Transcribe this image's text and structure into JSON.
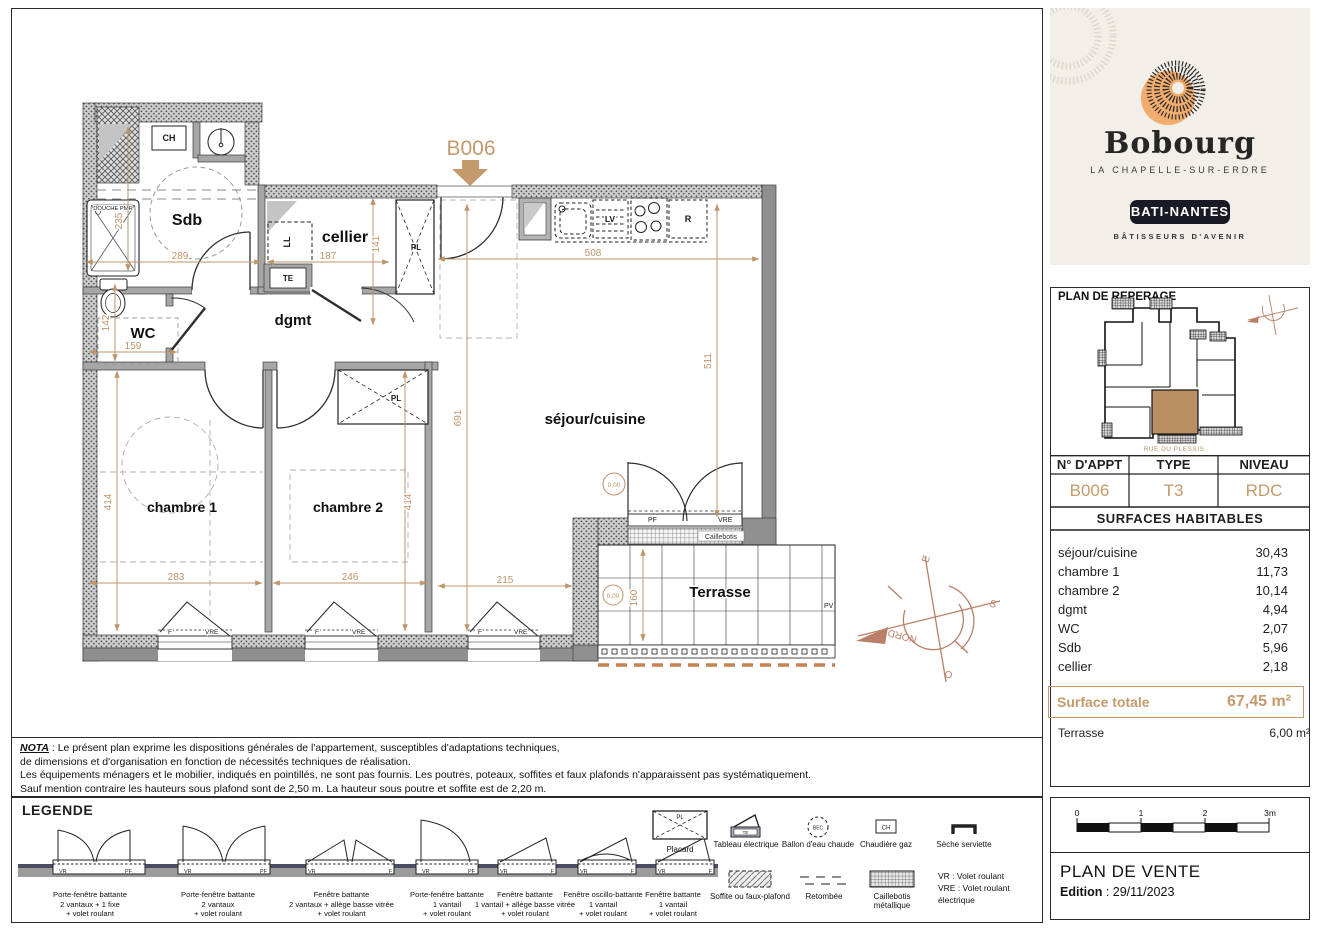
{
  "colors": {
    "accent": "#C49A6C",
    "terracotta": "#B97F68",
    "cream": "#F1EFE7",
    "wall": "#9a9a9a"
  },
  "brand": {
    "name": "Bobourg",
    "location": "LA CHAPELLE-SUR-ERDRE",
    "builder": "BATI-NANTES",
    "tagline": "BÂTISSEURS D'AVENIR"
  },
  "reperage": {
    "title": "PLAN DE REPERAGE",
    "street": "RUE DU PLESSIS"
  },
  "apt": {
    "col1": "N° D'APPT",
    "col2": "TYPE",
    "col3": "NIVEAU",
    "num": "B006",
    "type": "T3",
    "level": "RDC"
  },
  "surfaces": {
    "title": "SURFACES HABITABLES",
    "rows": [
      {
        "label": "séjour/cuisine",
        "value": "30,43"
      },
      {
        "label": "chambre 1",
        "value": "11,73"
      },
      {
        "label": "chambre 2",
        "value": "10,14"
      },
      {
        "label": "dgmt",
        "value": "4,94"
      },
      {
        "label": "WC",
        "value": "2,07"
      },
      {
        "label": "Sdb",
        "value": "5,96"
      },
      {
        "label": "cellier",
        "value": "2,18"
      }
    ],
    "total_label": "Surface totale",
    "total_value": "67,45 m²",
    "terrace_label": "Terrasse",
    "terrace_value": "6,00 m²"
  },
  "scalebar": {
    "t0": "0",
    "t1": "1",
    "t2": "2",
    "t3": "3m"
  },
  "vente": {
    "title": "PLAN DE VENTE",
    "edition_label": "Edition",
    "edition_value": " : 29/11/2023"
  },
  "nota": {
    "label": "NOTA",
    "l1": " : Le présent plan exprime les dispositions générales de l'appartement, susceptibles d'adaptations techniques,",
    "l2": "de dimensions et d'organisation en fonction de nécessités techniques de réalisation.",
    "l3": "Les équipements ménagers  et le mobilier, indiqués en pointillés, ne sont pas fournis. Les poutres, poteaux, soffites et faux plafonds n'apparaissent pas systématiquement.",
    "l4": "Sauf mention contraire les hauteurs sous plafond sont de 2,50 m. La hauteur sous poutre et soffite est de 2,20 m."
  },
  "legend": {
    "title": "LEGENDE",
    "items": [
      {
        "l1": "Porte-fenêtre battante",
        "l2": "2 vantaux + 1 fixe",
        "l3": "+ volet roulant"
      },
      {
        "l1": "Porte-fenêtre battante",
        "l2": "2 vantaux",
        "l3": "+ volet roulant"
      },
      {
        "l1": "Fenêtre battante",
        "l2": "2 vantaux + allège basse vitrée",
        "l3": "+ volet roulant"
      },
      {
        "l1": "Porte-fenêtre battante",
        "l2": "1 vantail",
        "l3": "+ volet roulant"
      },
      {
        "l1": "Fenêtre battante",
        "l2": "1 vantail + allège basse vitrée",
        "l3": "+ volet roulant"
      },
      {
        "l1": "Fenêtre oscillo-battante",
        "l2": "1 vantail",
        "l3": "+ volet roulant"
      },
      {
        "l1": "Fenêtre battante",
        "l2": "1 vantail",
        "l3": "+ volet roulant"
      }
    ],
    "placard": "Placard",
    "symbols": {
      "te": "Tableau électrique",
      "bec": "Ballon d'eau chaude",
      "ch": "Chaudière gaz",
      "ss": "Sèche serviette",
      "soffite": "Soffite ou faux-plafond",
      "retombee": "Retombée",
      "caillebotis": "Caillebotis métallique",
      "vr": "VR : Volet roulant",
      "vre": "VRE : Volet roulant électrique"
    }
  },
  "plan": {
    "unit": "B006",
    "rooms": {
      "sdb": "Sdb",
      "wc": "WC",
      "dgmt": "dgmt",
      "cellier": "cellier",
      "sejour": "séjour/cuisine",
      "ch1": "chambre 1",
      "ch2": "chambre 2",
      "terrasse": "Terrasse"
    },
    "fixtures": {
      "ch": "CH",
      "ll": "LL",
      "te": "TE",
      "pl": "PL",
      "lv": "LV",
      "r": "R",
      "pf": "PF",
      "vre": "VRE",
      "f": "F",
      "pv": "PV",
      "vr": "VR",
      "douche": "DOUCHE PMR",
      "caillebotis": "Caillebotis",
      "level": "0,00",
      "bec": "BEC"
    },
    "dims": {
      "d235": "235",
      "d289": "289",
      "d187": "187",
      "d141": "141",
      "d508": "508",
      "d511": "511",
      "d691": "691",
      "d142": "142",
      "d159": "159",
      "d414": "414",
      "d283": "283",
      "d246": "246",
      "d215": "215",
      "d160": "160"
    },
    "compass": {
      "n": "NORD",
      "e": "E",
      "s": "S",
      "o": "O"
    }
  }
}
